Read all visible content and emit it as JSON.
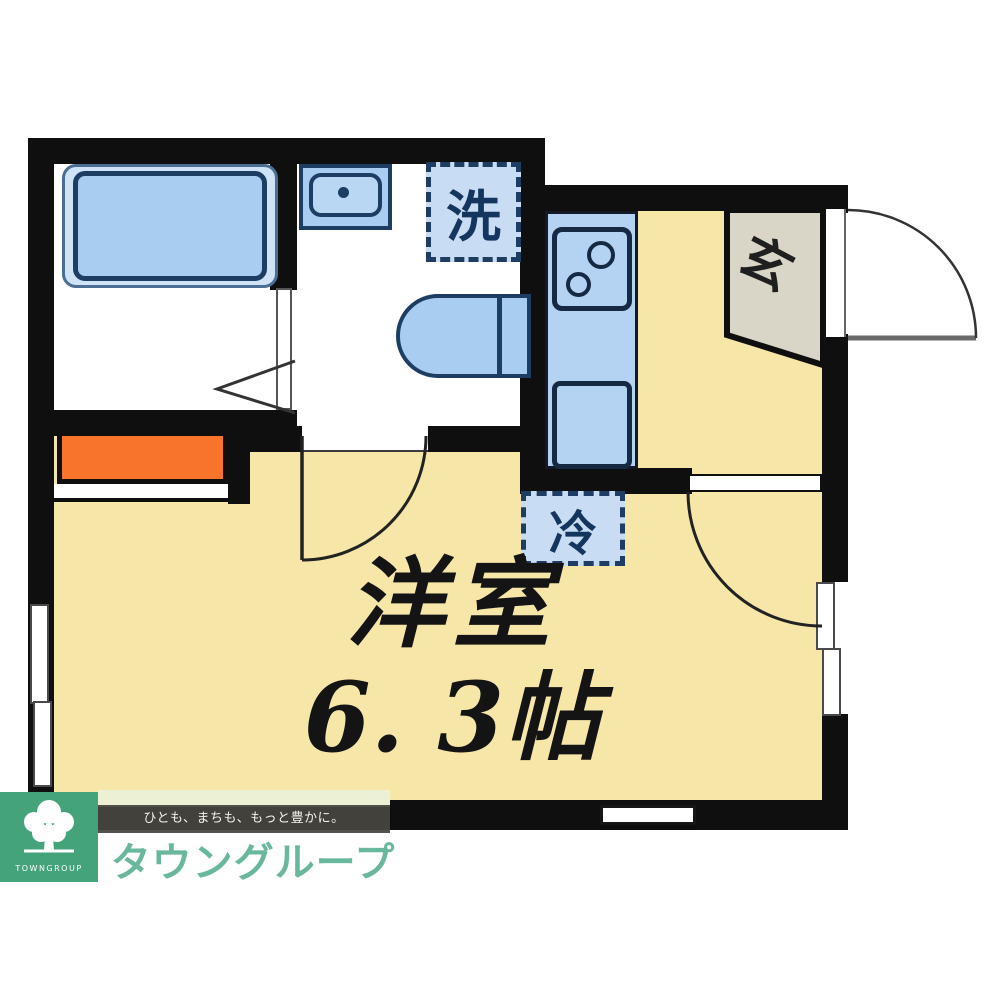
{
  "floor_plan": {
    "rooms": {
      "main_room": {
        "name": "洋室",
        "size": "6. 3帖"
      },
      "entrance_label": "玄",
      "washer_label": "洗",
      "refrigerator_label": "冷"
    },
    "colors": {
      "floor": "#f6e7a9",
      "wall": "#0f0f0f",
      "fixture_blue": "#a9cdf0",
      "fixture_border": "#1d3d63",
      "dashed_box_fill": "#c8dcf4",
      "entrance_gray": "#d9d5c7",
      "shelf_orange": "#f8742b"
    }
  },
  "logo": {
    "tagline": "ひとも、まちも、もっと豊かに。",
    "company_name": "タウングループ",
    "mark_text": "TOWNGROUP",
    "colors": {
      "square_green": "#45a37a",
      "text_green": "#69b79c",
      "band_dark": "#46453e",
      "accent_green": "#1d5f41",
      "pale_strip": "#ecf0d4"
    }
  }
}
